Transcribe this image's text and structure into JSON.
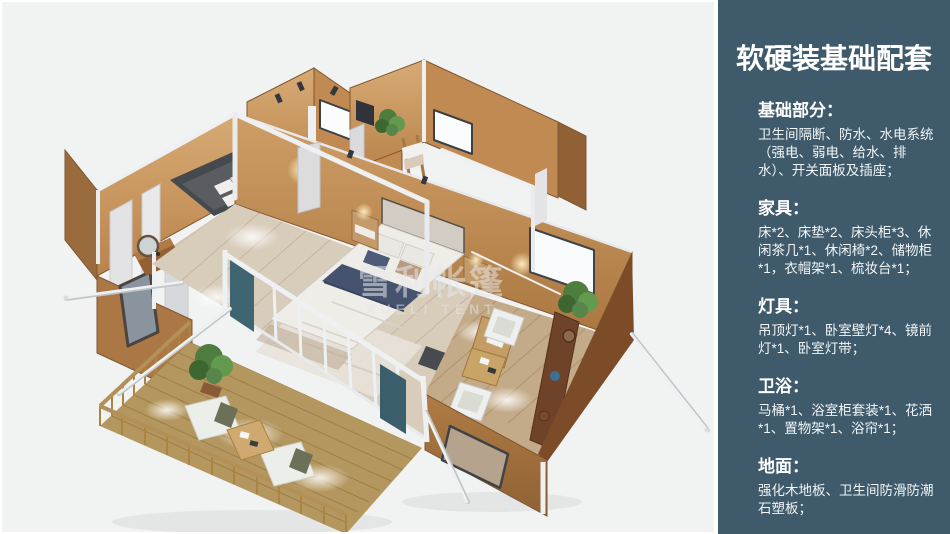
{
  "render": {
    "watermark": {
      "line1": "雪利帐篷",
      "line2": "XUELI TENT"
    }
  },
  "scene": {
    "colors": {
      "canvas-bg": "#f1f2f2",
      "sidebar-bg": "#3e5a6b",
      "wall-tan": "#c08a52",
      "wall-lit": "#cf9e66",
      "wall-dark": "#8f6134",
      "wall-front": "#a5743f",
      "floor-wood": "#d8ccba",
      "floor-lounge": "#c3aa89",
      "deck-wood": "#b4975e",
      "frame-white": "#eef0f2",
      "bedding-white": "#efede8",
      "bedding-navy": "#46536e",
      "curtain-teal": "#3f6472",
      "plant-green": "#57864a"
    }
  },
  "sidebar": {
    "title": "软硬装基础配套",
    "sections": [
      {
        "heading": "基础部分：",
        "body": "卫生间隔断、防水、水电系统（强电、弱电、给水、排水）、开关面板及插座；"
      },
      {
        "heading": "家具：",
        "body": "床*2、床垫*2、床头柜*3、休闲茶几*1、休闲椅*2、储物柜*1，衣帽架*1、梳妆台*1；"
      },
      {
        "heading": "灯具：",
        "body": "吊顶灯*1、卧室壁灯*4、镜前灯*1、卧室灯带；"
      },
      {
        "heading": "卫浴：",
        "body": "马桶*1、浴室柜套装*1、花洒*1、置物架*1、浴帘*1；"
      },
      {
        "heading": "地面：",
        "body": "强化木地板、卫生间防滑防潮石塑板；"
      }
    ]
  }
}
